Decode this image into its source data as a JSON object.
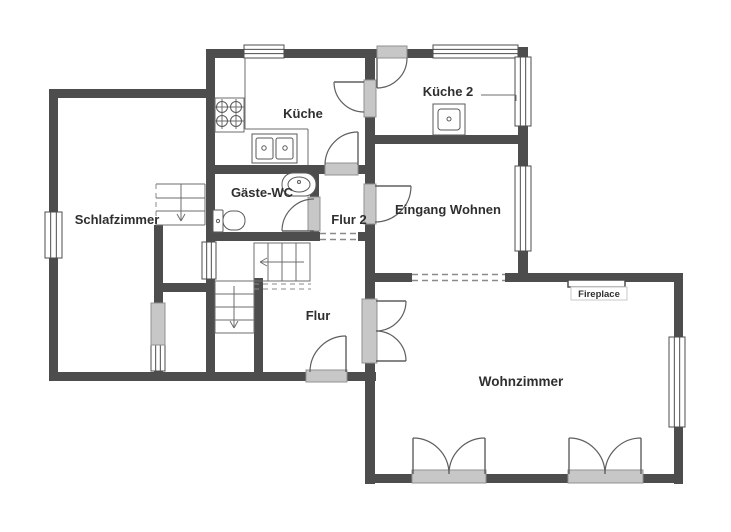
{
  "floorplan": {
    "canvas": {
      "w": 731,
      "h": 532,
      "background": "#ffffff"
    },
    "palette": {
      "wall": "#4d4d4d",
      "thin": "#6e6e6e",
      "fixture": "#5a5a5a",
      "door": "#5f5f5f",
      "dash": "#8a8a8a",
      "threshold_fill": "#c7c7c7",
      "threshold_stroke": "#909090",
      "window_fill": "#ffffff",
      "window_stroke": "#4d4d4d",
      "text": "#2f2f2f",
      "fire_box_stroke": "#c9c9c9"
    },
    "labels": [
      {
        "id": "room-label-schlafzimmer",
        "text": "Schlafzimmer",
        "x": 117,
        "y": 224,
        "size": 13,
        "weight": 700
      },
      {
        "id": "room-label-kueche",
        "text": "Küche",
        "x": 303,
        "y": 118,
        "size": 13,
        "weight": 700
      },
      {
        "id": "room-label-kueche-2",
        "text": "Küche 2",
        "x": 448,
        "y": 96,
        "size": 13,
        "weight": 700
      },
      {
        "id": "room-label-gaeste-wc",
        "text": "Gäste-WC",
        "x": 262,
        "y": 197,
        "size": 13,
        "weight": 700
      },
      {
        "id": "room-label-flur-2",
        "text": "Flur 2",
        "x": 349,
        "y": 224,
        "size": 13,
        "weight": 700
      },
      {
        "id": "room-label-eingang-wohnen",
        "text": "Eingang Wohnen",
        "x": 448,
        "y": 214,
        "size": 13,
        "weight": 700
      },
      {
        "id": "room-label-flur",
        "text": "Flur",
        "x": 318,
        "y": 320,
        "size": 13,
        "weight": 700
      },
      {
        "id": "room-label-wohnzimmer",
        "text": "Wohnzimmer",
        "x": 521,
        "y": 386,
        "size": 13.5,
        "weight": 700
      },
      {
        "id": "fireplace-label",
        "text": "Fireplace",
        "x": 599,
        "y": 297,
        "size": 9.5,
        "weight": 600
      }
    ],
    "walls": [
      {
        "name": "schlafzimmer-top-wall",
        "r": [
          49,
          89,
          166,
          9
        ]
      },
      {
        "name": "outer-left-wall",
        "r": [
          49,
          89,
          9,
          292
        ]
      },
      {
        "name": "outer-bottom-left-wall",
        "r": [
          49,
          372,
          327,
          9
        ]
      },
      {
        "name": "closet-left-wall",
        "r": [
          154,
          225,
          9,
          147
        ]
      },
      {
        "name": "closet-top-wall",
        "r": [
          154,
          283,
          61,
          9
        ]
      },
      {
        "name": "center-vertical-wall",
        "r": [
          206,
          49,
          9,
          323
        ]
      },
      {
        "name": "kitchen-bottom-wall",
        "r": [
          206,
          165,
          169,
          9
        ]
      },
      {
        "name": "wc-bottom-wall",
        "r": [
          206,
          232,
          169,
          9
        ]
      },
      {
        "name": "wc-right-wall",
        "r": [
          310,
          165,
          9,
          76
        ]
      },
      {
        "name": "stairwell-right-wall",
        "r": [
          254,
          278,
          9,
          94
        ]
      },
      {
        "name": "outer-top-wall",
        "r": [
          206,
          49,
          322,
          9
        ]
      },
      {
        "name": "mid-vertical-wall",
        "r": [
          365,
          49,
          10,
          435
        ]
      },
      {
        "name": "kueche2-bottom-wall",
        "r": [
          365,
          135,
          163,
          9
        ]
      },
      {
        "name": "outer-right-upper-wall",
        "r": [
          518,
          47,
          10,
          235
        ]
      },
      {
        "name": "wohnzimmer-top-wall",
        "r": [
          365,
          273,
          318,
          9
        ]
      },
      {
        "name": "wohnzimmer-right-wall",
        "r": [
          674,
          273,
          9,
          211
        ]
      },
      {
        "name": "wohnzimmer-bottom-wall",
        "r": [
          365,
          474,
          318,
          9
        ]
      }
    ],
    "windows": [
      {
        "name": "window-schlafzimmer-left",
        "r": [
          45,
          212,
          17,
          46
        ],
        "dir": "v"
      },
      {
        "name": "window-closet-left",
        "r": [
          151,
          344,
          14,
          27
        ],
        "dir": "v"
      },
      {
        "name": "window-stairwell-interior",
        "r": [
          202,
          242,
          14,
          37
        ],
        "dir": "v"
      },
      {
        "name": "window-kueche-top",
        "r": [
          244,
          45,
          40,
          13
        ],
        "dir": "h"
      },
      {
        "name": "window-kueche2-top",
        "r": [
          433,
          45,
          85,
          13
        ],
        "dir": "h"
      },
      {
        "name": "window-kueche2-right",
        "r": [
          515,
          57,
          16,
          69
        ],
        "dir": "v"
      },
      {
        "name": "window-eingang-right",
        "r": [
          515,
          166,
          16,
          85
        ],
        "dir": "v"
      },
      {
        "name": "window-wohnzimmer-right",
        "r": [
          669,
          337,
          16,
          90
        ],
        "dir": "v"
      }
    ],
    "thresholds": [
      {
        "name": "door-threshold-closet",
        "r": [
          151,
          303,
          14,
          42
        ]
      },
      {
        "name": "door-threshold-entry",
        "r": [
          306,
          370,
          41,
          12
        ]
      },
      {
        "name": "door-threshold-kueche-flur2",
        "r": [
          325,
          163,
          33,
          12
        ]
      },
      {
        "name": "door-threshold-wc",
        "r": [
          308,
          197,
          12,
          34
        ]
      },
      {
        "name": "door-threshold-kueche-kueche2",
        "r": [
          364,
          80,
          12,
          37
        ]
      },
      {
        "name": "door-threshold-kueche2-top",
        "r": [
          377,
          46,
          30,
          12
        ]
      },
      {
        "name": "door-threshold-eingang",
        "r": [
          364,
          184,
          12,
          40
        ]
      },
      {
        "name": "door-threshold-flur-wohnzimmer",
        "r": [
          362,
          299,
          15,
          64
        ]
      },
      {
        "name": "door-threshold-terrace-left",
        "r": [
          412,
          470,
          74,
          13
        ]
      },
      {
        "name": "door-threshold-terrace-right",
        "r": [
          568,
          470,
          75,
          13
        ]
      }
    ],
    "openings": [
      {
        "name": "opening-flur2-flur",
        "r": [
          320,
          232,
          38,
          9
        ],
        "lines": [
          [
            320,
            233.5,
            358,
            233.5
          ],
          [
            320,
            239.5,
            358,
            239.5
          ]
        ]
      },
      {
        "name": "opening-eingang-wohnzimmer",
        "r": [
          412,
          273,
          93,
          9
        ],
        "lines": [
          [
            412,
            274.5,
            505,
            274.5
          ],
          [
            412,
            280.5,
            505,
            280.5
          ]
        ]
      }
    ],
    "doors": [
      {
        "name": "door-entry",
        "leaf": [
          346,
          336,
          346,
          372
        ],
        "arc": "M 310 372 A 36 36 0 0 1 346 336"
      },
      {
        "name": "door-wc",
        "leaf": [
          282,
          231,
          314,
          231
        ],
        "arc": "M 282 231 A 32 32 0 0 1 314 199"
      },
      {
        "name": "door-kueche-flur2",
        "leaf": [
          358,
          132,
          358,
          165
        ],
        "arc": "M 325 165 A 33 33 0 0 1 358 132"
      },
      {
        "name": "door-kueche-kueche2",
        "leaf": [
          334,
          82,
          364,
          82
        ],
        "arc": "M 334 82 A 30 30 0 0 0 364 112"
      },
      {
        "name": "door-kueche2-top",
        "leaf": [
          377,
          58,
          377,
          88
        ],
        "arc": "M 377 88 A 30 30 0 0 0 407 58"
      },
      {
        "name": "door-eingang",
        "leaf": [
          375,
          186,
          411,
          186
        ],
        "arc": "M 411 186 A 36 36 0 0 1 375 222"
      },
      {
        "name": "double-door-flur-wohnzimmer-a",
        "leaf": [
          376,
          301,
          406,
          301
        ],
        "arc": "M 406 301 A 30 30 0 0 1 376 331"
      },
      {
        "name": "double-door-flur-wohnzimmer-b",
        "leaf": [
          376,
          361,
          406,
          361
        ],
        "arc": "M 406 361 A 30 30 0 0 0 376 331"
      },
      {
        "name": "double-door-terrace-left-a",
        "leaf": [
          413,
          438,
          413,
          474
        ],
        "arc": "M 413 438 A 36 36 0 0 1 449 474"
      },
      {
        "name": "double-door-terrace-left-b",
        "leaf": [
          485,
          438,
          485,
          474
        ],
        "arc": "M 485 438 A 36 36 0 0 0 449 474"
      },
      {
        "name": "double-door-terrace-right-a",
        "leaf": [
          569,
          438,
          569,
          474
        ],
        "arc": "M 569 438 A 36 36 0 0 1 605 474"
      },
      {
        "name": "double-door-terrace-right-b",
        "leaf": [
          641,
          438,
          641,
          474
        ],
        "arc": "M 641 438 A 36 36 0 0 0 605 474"
      }
    ],
    "rects": [
      {
        "name": "stair-upper-outline",
        "r": [
          254,
          243,
          56,
          38
        ],
        "k": "stair"
      },
      {
        "name": "stair-lower-outline",
        "r": [
          215,
          281,
          39,
          52
        ],
        "k": "stair"
      },
      {
        "name": "stove",
        "r": [
          215,
          98,
          29,
          34
        ],
        "k": "stair"
      },
      {
        "name": "kitchen-sink-unit",
        "r": [
          252,
          134,
          45,
          29
        ],
        "k": "fixture"
      },
      {
        "name": "kitchen-sink-basin-left",
        "r": [
          256,
          138,
          17,
          21
        ],
        "rx": 2,
        "k": "fixture"
      },
      {
        "name": "kitchen-sink-basin-right",
        "r": [
          276,
          138,
          17,
          21
        ],
        "rx": 2,
        "k": "fixture"
      },
      {
        "name": "wc-sink",
        "r": [
          282,
          173,
          34,
          23
        ],
        "rx": 11,
        "k": "fixture"
      },
      {
        "name": "toilet-tank",
        "r": [
          213,
          210,
          10,
          22
        ],
        "rx": 1,
        "k": "fixture"
      },
      {
        "name": "toilet-bowl",
        "r": [
          223,
          211,
          22,
          19
        ],
        "rx": 9,
        "k": "fixture"
      },
      {
        "name": "kueche2-appliance",
        "r": [
          433,
          104,
          32,
          31
        ],
        "k": "fixture"
      },
      {
        "name": "kueche2-appliance-inner",
        "r": [
          438,
          109,
          22,
          21
        ],
        "rx": 3,
        "k": "fixture"
      },
      {
        "name": "fireplace-bar",
        "r": [
          568,
          280,
          57,
          7
        ],
        "k": "firebar"
      },
      {
        "name": "fireplace-label-box",
        "r": [
          571,
          287,
          56,
          13
        ],
        "k": "firebox"
      }
    ],
    "lines": [
      {
        "name": "counter-edge",
        "p": [
          245,
          58,
          245,
          129
        ],
        "k": "thin"
      },
      {
        "name": "counter-edge",
        "p": [
          245,
          129,
          308,
          129
        ],
        "k": "thin"
      },
      {
        "name": "counter-edge",
        "p": [
          308,
          129,
          308,
          165
        ],
        "k": "thin"
      },
      {
        "name": "stair-upper-tread",
        "p": [
          268,
          243,
          268,
          281
        ],
        "k": "thin"
      },
      {
        "name": "stair-upper-tread",
        "p": [
          282,
          243,
          282,
          281
        ],
        "k": "thin"
      },
      {
        "name": "stair-upper-tread",
        "p": [
          296,
          243,
          296,
          281
        ],
        "k": "thin"
      },
      {
        "name": "stair-upper-arrow",
        "p": [
          304,
          262,
          261,
          262
        ],
        "k": "thin"
      },
      {
        "name": "stair-upper-arrowhead",
        "p": [
          267,
          258,
          260,
          262
        ],
        "k": "thin"
      },
      {
        "name": "stair-upper-arrowhead",
        "p": [
          267,
          266,
          260,
          262
        ],
        "k": "thin"
      },
      {
        "name": "stair-lower-tread",
        "p": [
          215,
          294,
          254,
          294
        ],
        "k": "thin"
      },
      {
        "name": "stair-lower-tread",
        "p": [
          215,
          307,
          254,
          307
        ],
        "k": "thin"
      },
      {
        "name": "stair-lower-tread",
        "p": [
          215,
          320,
          254,
          320
        ],
        "k": "thin"
      },
      {
        "name": "stair-lower-arrow",
        "p": [
          234,
          286,
          234,
          327
        ],
        "k": "thin"
      },
      {
        "name": "stair-lower-arrowhead",
        "p": [
          230,
          321,
          234,
          328
        ],
        "k": "thin"
      },
      {
        "name": "stair-lower-arrowhead",
        "p": [
          238,
          321,
          234,
          328
        ],
        "k": "thin"
      },
      {
        "name": "stair-schlafzimmer-edge",
        "p": [
          156,
          184,
          205,
          184
        ],
        "k": "thin"
      },
      {
        "name": "stair-schlafzimmer-edge",
        "p": [
          205,
          184,
          205,
          225
        ],
        "k": "thin"
      },
      {
        "name": "stair-schlafzimmer-edge",
        "p": [
          156,
          225,
          205,
          225
        ],
        "k": "thin"
      },
      {
        "name": "stair-schlafzimmer-edge-dashed",
        "p": [
          156,
          184,
          156,
          225
        ],
        "k": "dash"
      },
      {
        "name": "stair-schlafzimmer-tread",
        "p": [
          156,
          198,
          205,
          198
        ],
        "k": "thin"
      },
      {
        "name": "stair-schlafzimmer-tread",
        "p": [
          156,
          211,
          205,
          211
        ],
        "k": "thin"
      },
      {
        "name": "stair-schlafzimmer-tread",
        "p": [
          181,
          184,
          181,
          211
        ],
        "k": "thin"
      },
      {
        "name": "stair-schlafzimmer-arrow",
        "p": [
          181,
          196,
          181,
          220
        ],
        "k": "thin"
      },
      {
        "name": "stair-schlafzimmer-arrowhead",
        "p": [
          177,
          214,
          181,
          221
        ],
        "k": "thin"
      },
      {
        "name": "stair-schlafzimmer-arrowhead",
        "p": [
          185,
          214,
          181,
          221
        ],
        "k": "thin"
      },
      {
        "name": "stair-upper-overhead-dashed",
        "p": [
          254,
          284,
          311,
          284
        ],
        "k": "dash"
      },
      {
        "name": "stair-upper-overhead-dashed",
        "p": [
          254,
          289,
          311,
          289
        ],
        "k": "dash"
      },
      {
        "name": "kueche2-leader",
        "p": [
          481,
          95,
          516,
          95
        ],
        "k": "thin"
      },
      {
        "name": "kueche2-leader",
        "p": [
          516,
          95,
          516,
          101
        ],
        "k": "thin"
      },
      {
        "name": "stove-cross",
        "p": [
          214,
          107,
          230,
          107
        ],
        "k": "thin"
      },
      {
        "name": "stove-cross",
        "p": [
          222,
          99,
          222,
          115
        ],
        "k": "thin"
      },
      {
        "name": "stove-cross",
        "p": [
          228,
          107,
          244,
          107
        ],
        "k": "thin"
      },
      {
        "name": "stove-cross",
        "p": [
          236,
          99,
          236,
          115
        ],
        "k": "thin"
      },
      {
        "name": "stove-cross",
        "p": [
          214,
          121,
          230,
          121
        ],
        "k": "thin"
      },
      {
        "name": "stove-cross",
        "p": [
          222,
          113,
          222,
          129
        ],
        "k": "thin"
      },
      {
        "name": "stove-cross",
        "p": [
          228,
          121,
          244,
          121
        ],
        "k": "thin"
      },
      {
        "name": "stove-cross",
        "p": [
          236,
          113,
          236,
          129
        ],
        "k": "thin"
      }
    ],
    "circles": [
      {
        "name": "stove-burner",
        "c": [
          222,
          107,
          5.5
        ]
      },
      {
        "name": "stove-burner",
        "c": [
          236,
          107,
          5.5
        ]
      },
      {
        "name": "stove-burner",
        "c": [
          222,
          121,
          5.5
        ]
      },
      {
        "name": "stove-burner",
        "c": [
          236,
          121,
          5.5
        ]
      },
      {
        "name": "sink-drain",
        "c": [
          264,
          148,
          2.2
        ]
      },
      {
        "name": "sink-drain",
        "c": [
          285,
          148,
          2.2
        ]
      },
      {
        "name": "wc-sink-drain",
        "c": [
          299,
          182,
          1.5
        ]
      },
      {
        "name": "toilet-flush-dot",
        "c": [
          218,
          221,
          1.6
        ]
      },
      {
        "name": "appliance-dot",
        "c": [
          449,
          119,
          2
        ]
      }
    ],
    "ellipses": [
      {
        "name": "wc-sink-bowl",
        "e": [
          299,
          184.5,
          11,
          7.5
        ]
      }
    ]
  }
}
